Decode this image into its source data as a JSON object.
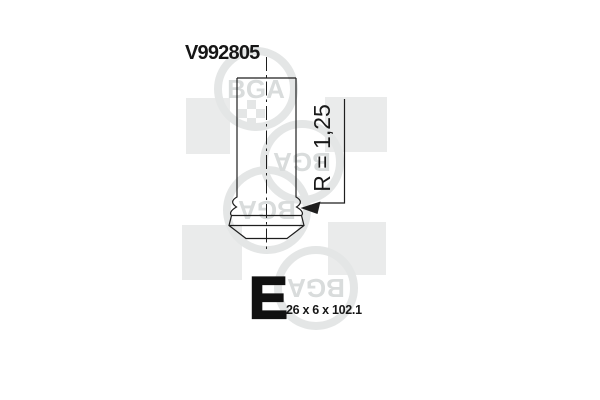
{
  "product": {
    "part_number": "V992805",
    "valve_letter": "E",
    "size_label": "26 x 6 x 102.1",
    "radius_label": "R = 1,25"
  },
  "watermark": {
    "logo_text": "BGA",
    "square_color": "#eaebeb",
    "ring_color": "#e4e6e6",
    "text_color": "#d9dcdc"
  },
  "drawing": {
    "line_color": "#1e1e1e"
  }
}
